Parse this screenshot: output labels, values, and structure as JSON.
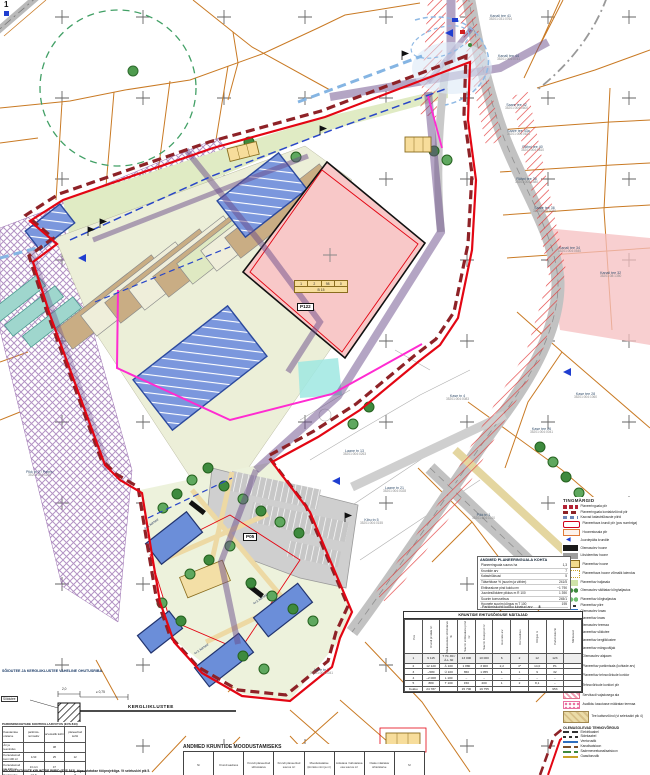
{
  "meta": {
    "corner_mark": "1"
  },
  "colors": {
    "boundary_red": "#E30613",
    "contact_maroon": "#8E2227",
    "cadastral_orange": "#C97A24",
    "corridor_purple": "#6A4B8A",
    "parcel_pink": "#F8C8C8",
    "building_blue": "#6B8ED9",
    "utility_magenta": "#FF2BD1"
  },
  "map_labels": {
    "parcels": [
      {
        "name": "Kanali tee 41",
        "code": "35201:031:0764"
      },
      {
        "name": "Kanali tee 44",
        "code": "35201:004:0741"
      },
      {
        "name": "Saare tee 42",
        "code": "35201:004:0600"
      },
      {
        "name": "Saare tee 43a",
        "code": "35201:004:0621"
      },
      {
        "name": "Rähni tee 40",
        "code": "35201:004:0810"
      },
      {
        "name": "Rähni tee 38",
        "code": "35201:004:1580"
      },
      {
        "name": "Saare tee 36",
        "code": "35201:004:0020"
      },
      {
        "name": "Kanali tee 34",
        "code": "35201:004:0540"
      },
      {
        "name": "Kanali tee 32",
        "code": "35201:08:1350"
      },
      {
        "name": "Kase tee 28",
        "code": "35201:004:1060"
      },
      {
        "name": "Kase tee 26",
        "code": "35201:004:0041"
      },
      {
        "name": "Pikk tn 2 / Parmu",
        "code": "35201:004:0120"
      },
      {
        "name": "Laane tn 13",
        "code": "35201:004:0263"
      },
      {
        "name": "Laane tn 21",
        "code": "35201:004:0028"
      },
      {
        "name": "Kase tn 4",
        "code": "35201:004:0083"
      },
      {
        "name": "Kibu tn 5",
        "code": "35201:004:0155"
      },
      {
        "name": "Pikk tn 1",
        "code": "35201:004:1010"
      },
      {
        "name": "Vahe tn 2",
        "code": "35201:004:0041"
      },
      {
        "name": "Jaama tn 4",
        "code": "35201:006:1360"
      }
    ],
    "pos_tags": [
      "P122",
      "P05"
    ],
    "storey_labels": [
      "4+1 korrust",
      "4+1 korrust",
      "4+1 korrust"
    ],
    "center_table": {
      "cells": [
        "1",
        "2",
        "98",
        "0"
      ],
      "caption": "B 15"
    }
  },
  "legend": {
    "title": "TINGMÄRGID",
    "items": [
      {
        "icon": "boundary-red",
        "label": "Planeeringuala piir"
      },
      {
        "icon": "boundary-maroon",
        "label": "Planeeringuala kontaktvööndi piir"
      },
      {
        "icon": "boundary-bluegray",
        "label": "Kaovad katastriüksuste piirid"
      },
      {
        "icon": "plot-outline-red",
        "label": "Planeeritava krundi piir (pos numbriga)"
      },
      {
        "icon": "building-area-orange",
        "label": "Hoonestusala piir"
      },
      {
        "icon": "access-arrow",
        "label": "Juurdepääs krundile"
      },
      {
        "icon": "existing-building",
        "label": "Olemasolev hoone"
      },
      {
        "icon": "demolish-building",
        "label": "Likvideeritav hoone"
      },
      {
        "icon": "planned-building",
        "label": "Planeeritav hoone"
      },
      {
        "icon": "planned-building-opt",
        "label": "Planeeritava hoone võimalik laiendus"
      },
      {
        "icon": "lawn",
        "label": "Planeeritav haljasala"
      },
      {
        "icon": "trees-existing",
        "label": "Olemasolev säilitatav kõrghaljastus"
      },
      {
        "icon": "trees-planned",
        "label": "Planeeritav kõrghaljastus"
      },
      {
        "icon": "fence",
        "label": "Planeeritav piire"
      },
      {
        "icon": "ditch-existing",
        "label": "Olemasolev kraav"
      },
      {
        "icon": "ditch-planned",
        "label": "Planeeritav kraav"
      },
      {
        "icon": "road-existing",
        "label": "Olemasolev teemaa"
      },
      {
        "icon": "road-planned",
        "label": "Planeeritav sõidutee"
      },
      {
        "icon": "cycleway",
        "label": "Planeeritav kergliiklustee"
      },
      {
        "icon": "playground",
        "label": "Planeeritav mänguväljak"
      },
      {
        "icon": "substation",
        "label": "Olemasolev alajaam"
      },
      {
        "icon": "parking",
        "label": "Planeeritav parkimisala (kohtade arv)"
      },
      {
        "icon": "utility-corridor",
        "label": "Planeeritav tehnovõrkude koridor"
      },
      {
        "icon": "utility-corridor-outline",
        "label": "Tehnovõrkude koridori piir"
      },
      {
        "icon": "servitude",
        "label": "Servituudi vajadusega ala"
      },
      {
        "icon": "public-road-area",
        "label": "Avalikku kasutusse määratav teemaa"
      },
      {
        "icon": "road-protection",
        "label": "Tee kaitsevöönd (vt seletuskiri ptk 4)"
      }
    ],
    "subtitle": "OLEMASOLEVAD TEHNOVÕRGUD",
    "utilities": [
      {
        "icon": "power-cable",
        "label": "Elektrikaabel"
      },
      {
        "icon": "comm-cable",
        "label": "Sidekaabel"
      },
      {
        "icon": "water-pipe",
        "label": "Veetorustik"
      },
      {
        "icon": "sewer",
        "label": "Kanalisatsioon"
      },
      {
        "icon": "storm-sewer",
        "label": "Sademeveekanalisatsioon"
      },
      {
        "icon": "gas-pipe",
        "label": "Gaasitorustik"
      }
    ]
  },
  "info_box": {
    "title": "ANDMED PLANEERINGUALA KOHTA",
    "rows": [
      [
        "Planeeringuala suurus ha",
        "1,3"
      ],
      [
        "Kruntide arv",
        "7"
      ],
      [
        "Katastriüksusi",
        "5"
      ],
      [
        "Täisehituse % (suurim ja vähim)",
        "241/5"
      ],
      [
        "Ehitisealune pind kokku m²",
        "~1 790"
      ],
      [
        "Juurdesõidutee pikkus m R 100",
        "1 390"
      ],
      [
        "Suurim korruselisus",
        "245/1"
      ],
      [
        "Hoonete suurim kõrgus m T 100",
        "195"
      ]
    ],
    "note_label": "Parkimiskohti kokku lubatud arv",
    "note_value": "8"
  },
  "build_right": {
    "title": "KRUNTIDE EHITUSÕIGUSE NÄITAJAD",
    "head": [
      [
        "Pos",
        "Krundi pindala m²",
        "Maakasutuse sihtotstarve %",
        "Suurim ehitisealune pind m²",
        "Suurim brutopind m²",
        "Hoonete arv",
        "Korruselisus",
        "Kõrgus m",
        "Parkimiskohti",
        "Märkused"
      ]
    ],
    "rows": [
      [
        "1",
        "9 115",
        "T 70..80 / Ä-L 30",
        "13 000",
        "10 000",
        "6",
        "2",
        "12",
        "123",
        ""
      ],
      [
        "2",
        "12 120",
        "Ä 100",
        "1 880",
        "3 900",
        "2,2",
        "4*",
        "14,0",
        "P1",
        ""
      ],
      [
        "3",
        "~580",
        "Ü 100",
        "650",
        "1 055",
        "1",
        "1",
        "9",
        "32",
        ""
      ],
      [
        "4",
        "~2 008",
        "L 100",
        "–",
        "–",
        "–",
        "–",
        "–",
        "–",
        ""
      ],
      [
        "5",
        "880",
        "T 100",
        "150",
        "200",
        "1",
        "2",
        "8,1",
        "–",
        ""
      ],
      [
        "Kokku",
        "24 787",
        "",
        "15 700",
        "19 755",
        "",
        "",
        "",
        "953",
        ""
      ]
    ]
  },
  "plots_table": {
    "title": "ANDMED KRUNTIDE MOODUSTAMISEKS",
    "head": [
      [
        "Nr",
        "Krundi aadress",
        "Krundi planeeritud sihtotstarve",
        "Krundi planeeritud suurus m²",
        "Moodustatakse (kinnistu nimi ja nr)",
        "Liidetava / lahutatava osa suurus m²",
        "Osale määratav sihtotstarve",
        "M"
      ]
    ]
  },
  "section": {
    "title": "SÕIDUTEE JA KERGLIIKLUSTEE VAHELINE OHUTUSRIBA.",
    "left_label": "Sõidutee",
    "right_label": "KERGLIIKLUSTEE",
    "dim1": "2,0",
    "dim2": "≥ 0,75",
    "footnote": "MOODUSTATAVATE KRUNTIDE PIIRID (EVS 843), täpsustatakse tööprojektiga. Vt seletuskiri ptk 5."
  },
  "parking_table": {
    "title": "PARKIMISKOHTADE KONTROLLARVUTUS (EVS 843)",
    "head": [
      [
        "Kasutamise otstarve",
        "parkimis- normatiiv",
        "arvutuslik kohti",
        "planeeritud kohti"
      ]
    ],
    "rows": [
      [
        "Äri ja teenindus",
        "",
        "38",
        ""
      ],
      [
        "Korterelamud kuni 100 m²",
        "1/10",
        "25",
        "12"
      ],
      [
        "Korterelamud üle 100 m²",
        "1/1 krt",
        "47",
        ""
      ],
      [
        "Kaubandus",
        "1/1,5",
        "",
        "8"
      ],
      [
        "Lasteaed, külastajad",
        "",
        "",
        "8"
      ],
      [
        "KOKKU",
        "",
        "128",
        "28"
      ]
    ]
  }
}
